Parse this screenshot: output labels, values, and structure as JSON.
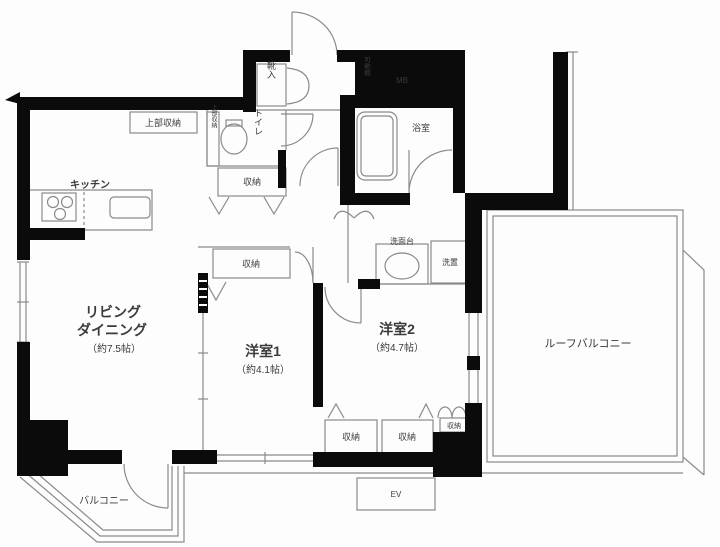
{
  "colors": {
    "wall": "#0b0b0b",
    "line": "#8a8a8a",
    "line_dark": "#6f6f6f",
    "text": "#3a3a3a",
    "bg": "#fdfdfd"
  },
  "rooms": {
    "living_dining": {
      "line1": "リビング",
      "line2": "ダイニング",
      "area": "（約7.5帖）"
    },
    "bedroom1": {
      "name": "洋室1",
      "area": "（約4.1帖）"
    },
    "bedroom2": {
      "name": "洋室2",
      "area": "（約4.7帖）"
    },
    "kitchen": {
      "name": "キッチン"
    },
    "bathroom": {
      "name": "浴室"
    },
    "toilet": {
      "name": "トイレ"
    },
    "balcony": {
      "name": "バルコニー"
    },
    "roof_balcony": {
      "name": "ルーフバルコニー"
    }
  },
  "fixtures": {
    "washstand": "洗面台",
    "laundry": "洗置",
    "shoe_cabinet": "靴入",
    "movable_shelf": "可動棚",
    "meter_box": "MB",
    "elevator": "EV"
  },
  "storage": {
    "upper_top": "上部収納",
    "upper_side": "上部収納",
    "closet_hall": "収納",
    "closet_bedroom1": "収納",
    "closet_bedroom2_left": "収納",
    "closet_bedroom2_right": "収納",
    "closet_bedroom2_small": "収納"
  }
}
